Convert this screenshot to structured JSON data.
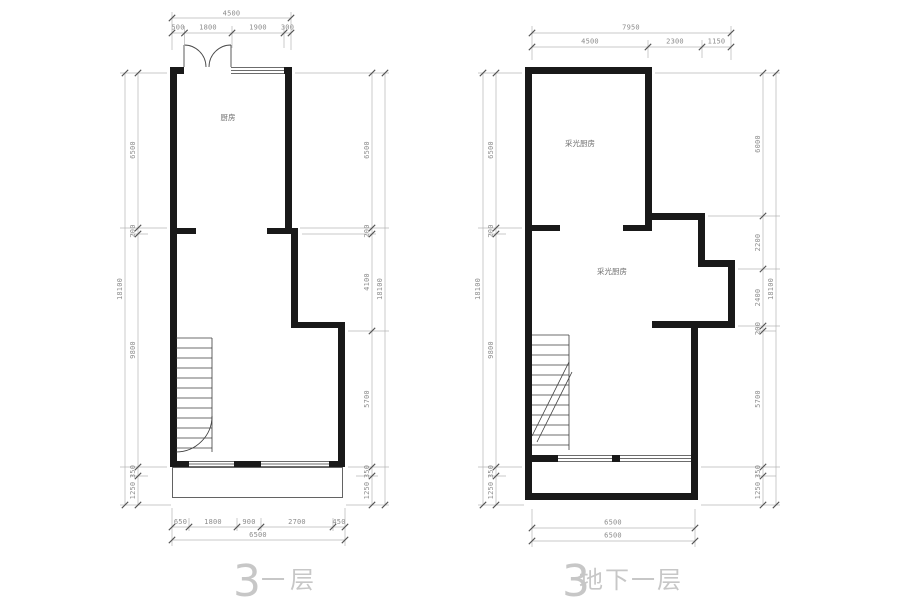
{
  "colors": {
    "background": "#ffffff",
    "wall": "#191919",
    "thin_line": "#3c3c3c",
    "dimension_line": "#b6b6b6",
    "dimension_text": "#8c8c8c",
    "caption_text": "#c7c7c7",
    "room_label_text": "#6e6e6e"
  },
  "captions": {
    "left_num": "3",
    "left_label": "一层",
    "right_num": "3",
    "right_label": "地下一层"
  },
  "left_plan": {
    "room_label": "厨房",
    "top": {
      "total": "4500",
      "segs": [
        "500",
        "1800",
        "1900",
        "300"
      ]
    },
    "left_chain": {
      "total": "18100",
      "segs": [
        "6500",
        "200",
        "9800",
        "350",
        "1250"
      ]
    },
    "right_chain": {
      "total": "18100",
      "segs": [
        "6500",
        "200",
        "4100",
        "5700",
        "350",
        "1250"
      ]
    },
    "bottom": {
      "total": "6500",
      "segs": [
        "650",
        "1800",
        "900",
        "2700",
        "450"
      ]
    }
  },
  "right_plan": {
    "room_label_upper": "采光厨房",
    "room_label_lower": "采光厨房",
    "top": {
      "total": "7950",
      "segs": [
        "4500",
        "2300",
        "1150"
      ]
    },
    "left_chain": {
      "total": "18100",
      "segs": [
        "6500",
        "200",
        "9800",
        "350",
        "1250"
      ]
    },
    "right_chain": {
      "total": "18100",
      "segs": [
        "6000",
        "2200",
        "2400",
        "200",
        "5700",
        "350",
        "1250"
      ]
    },
    "bottom": {
      "line1": "6500",
      "line2": "6500"
    }
  }
}
